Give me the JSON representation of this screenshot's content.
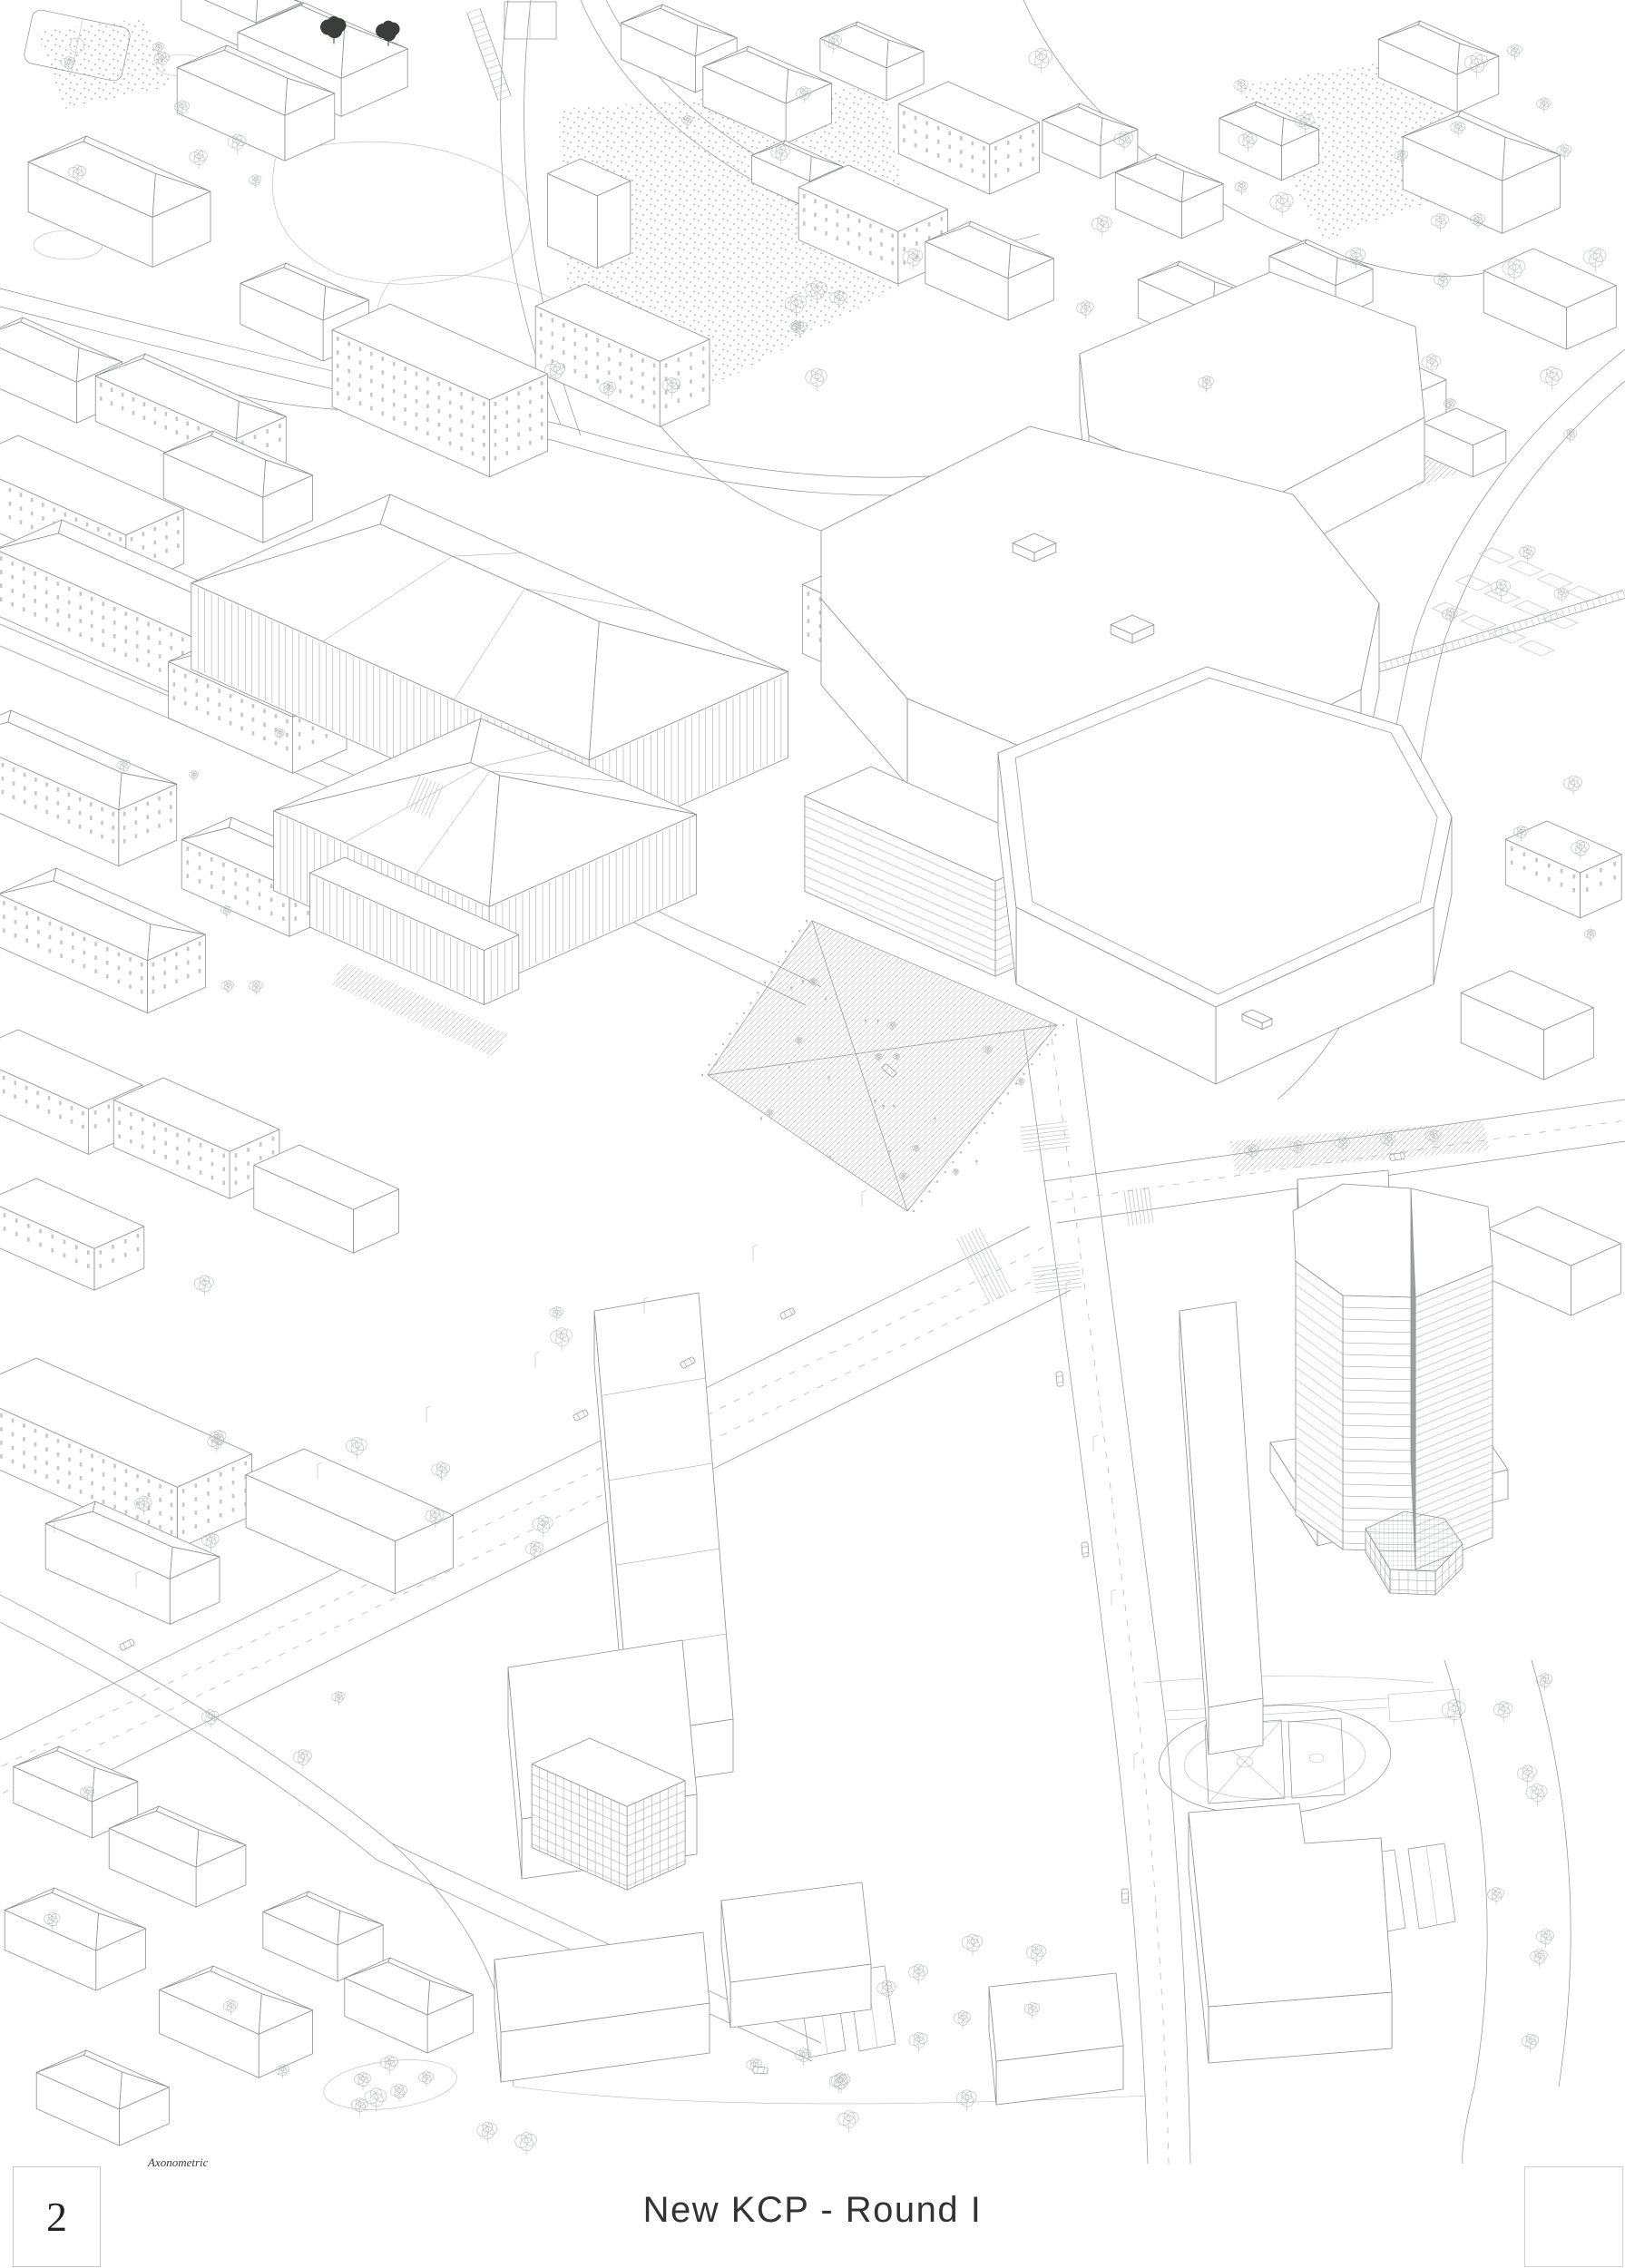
{
  "page": {
    "number": "2",
    "drawing_label": "Axonometric",
    "title": "New KCP - Round I"
  },
  "colors": {
    "line": "#8d9092",
    "line_light": "#b7babb",
    "dark_tree": "#3a3e3a",
    "text": "#333333",
    "background": "#ffffff"
  }
}
